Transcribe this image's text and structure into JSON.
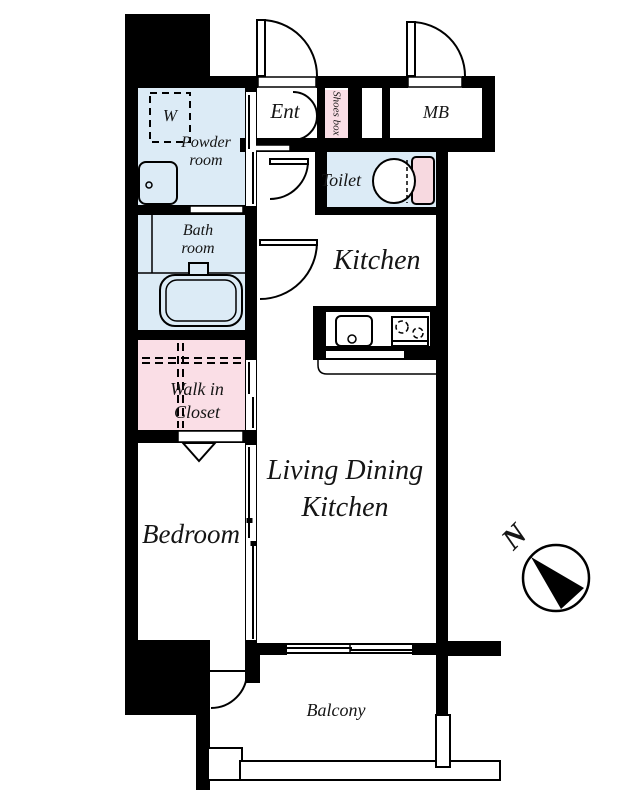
{
  "rooms": {
    "powder_room": {
      "label": "Powder room"
    },
    "washer": {
      "label": "W"
    },
    "bath_room": {
      "label": "Bath room"
    },
    "walk_in_closet": {
      "label": "Walk in Closet"
    },
    "bedroom": {
      "label": "Bedroom"
    },
    "entrance": {
      "label": "Ent"
    },
    "shoes_box": {
      "label": "Shoes box"
    },
    "meter_box": {
      "label": "MB"
    },
    "toilet": {
      "label": "Toilet"
    },
    "kitchen": {
      "label": "Kitchen"
    },
    "living_dining_kitchen": {
      "label": "Living Dining Kitchen"
    },
    "balcony": {
      "label": "Balcony"
    }
  },
  "compass": {
    "north_label": "N"
  },
  "palette": {
    "wall_black": "#000000",
    "wet_area_blue": "#dcebf6",
    "closet_pink": "#fadee6",
    "toilet_tank_pink": "#f7d9e0",
    "background": "#ffffff"
  }
}
